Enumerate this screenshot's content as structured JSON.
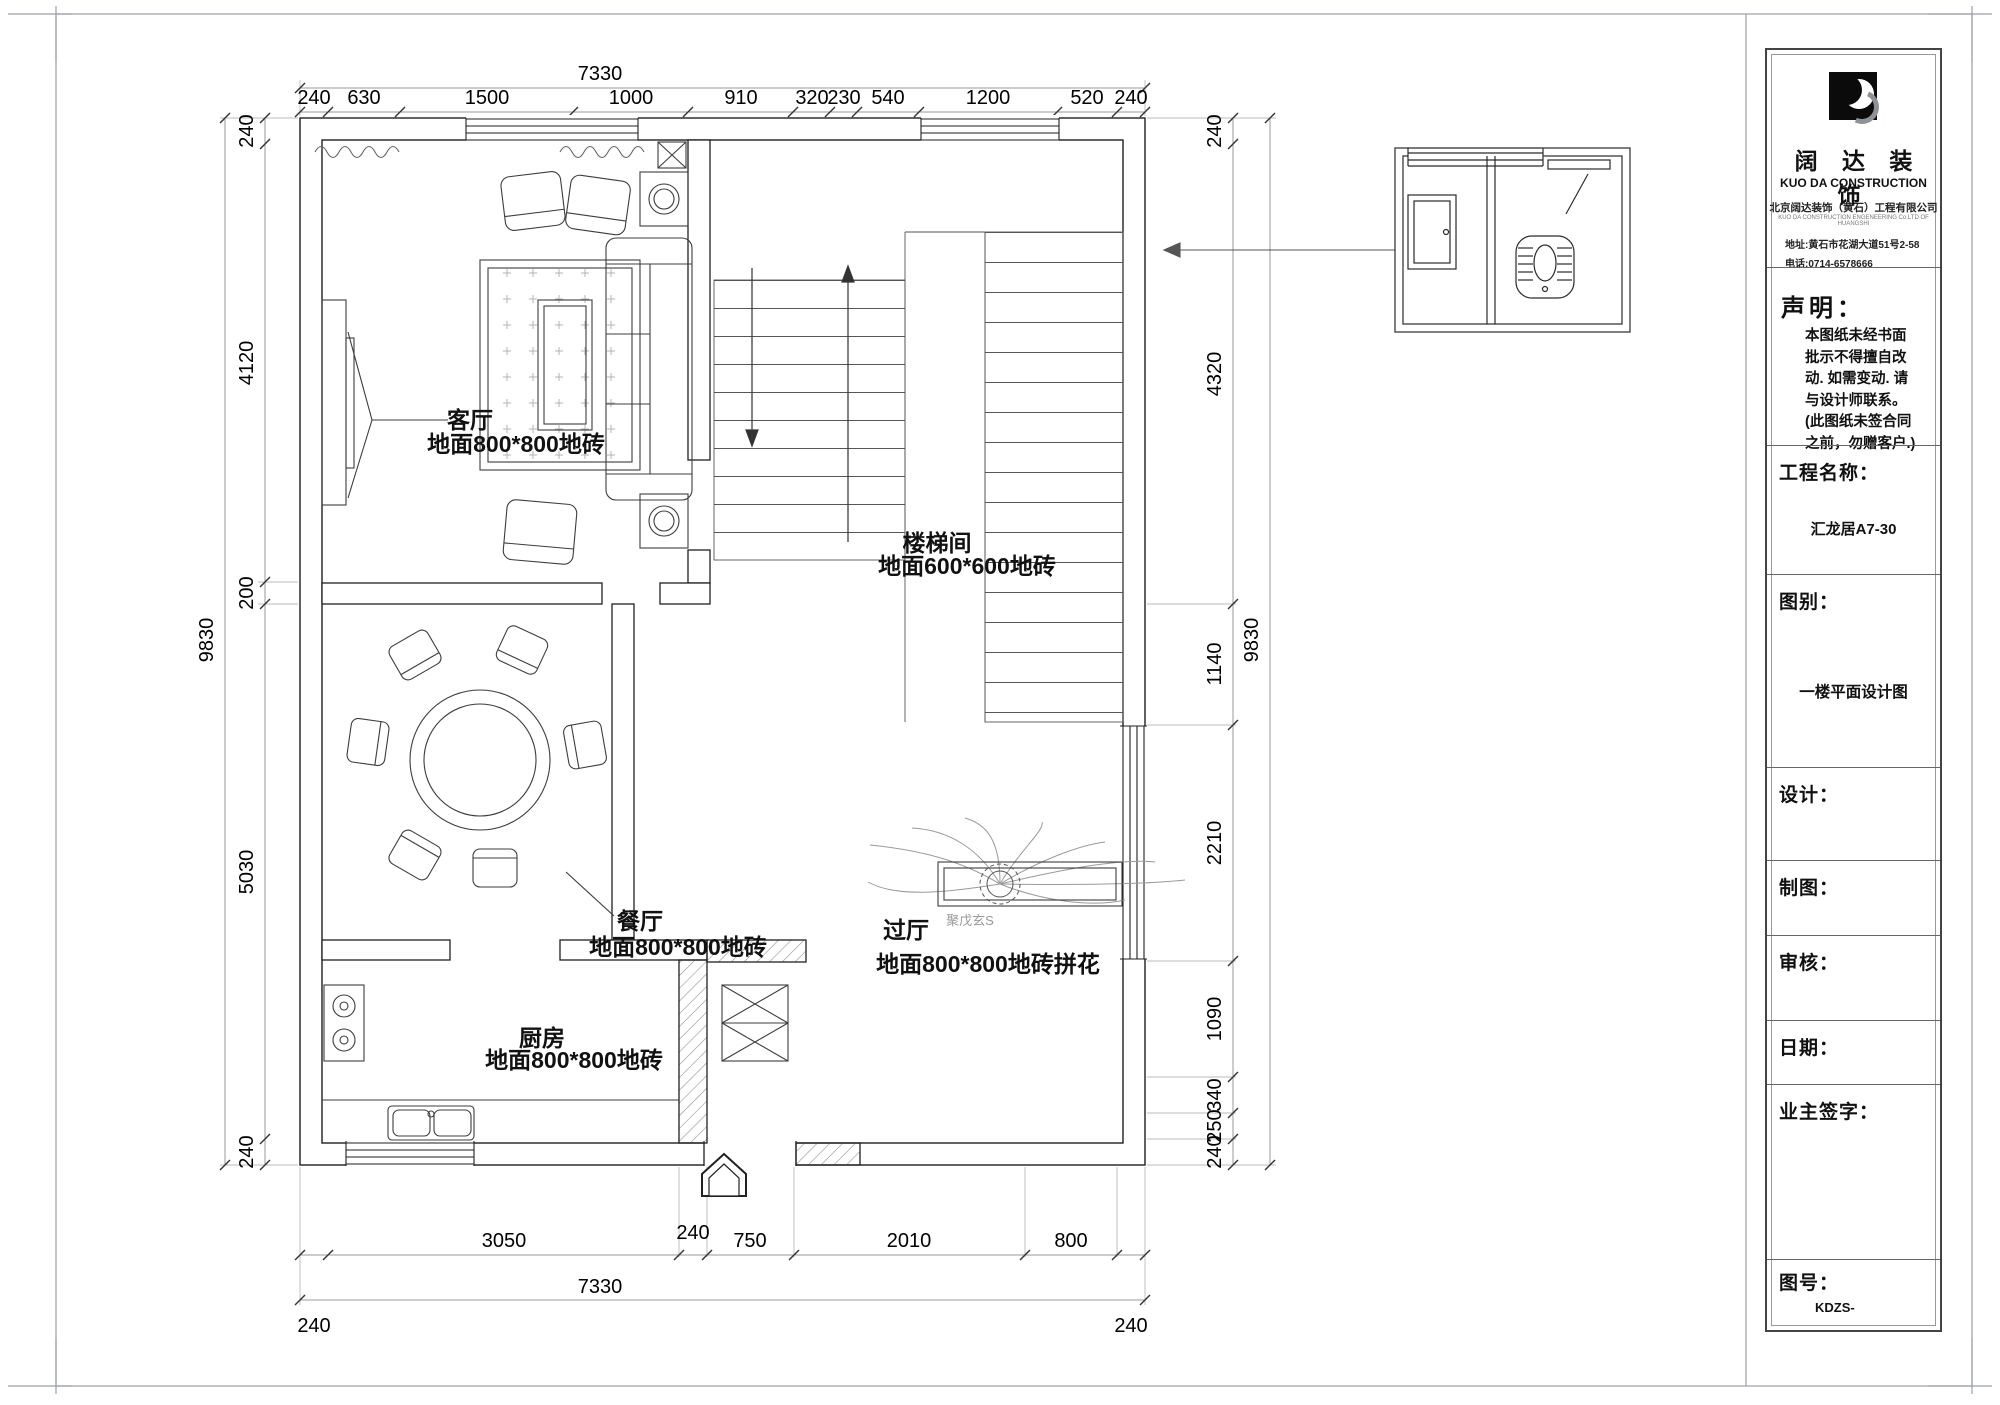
{
  "plan": {
    "rooms": {
      "living": {
        "name": "客厅",
        "floor": "地面800*800地砖"
      },
      "stair": {
        "name": "楼梯间",
        "floor": "地面600*600地砖"
      },
      "dining": {
        "name": "餐厅",
        "floor": "地面800*800地砖"
      },
      "kitchen": {
        "name": "厨房",
        "floor": "地面800*800地砖"
      },
      "hall": {
        "name": "过厅",
        "floor": "地面800*800地砖拼花"
      }
    },
    "watermark": "聚戊玄S"
  },
  "dims": {
    "top": {
      "overall": "7330",
      "segs": [
        "240",
        "630",
        "1500",
        "1000",
        "910",
        "320",
        "230",
        "540",
        "1200",
        "520",
        "240"
      ]
    },
    "bottom": {
      "overall": "7330",
      "upper": [
        "3050",
        "240",
        "750",
        "2010",
        "800"
      ],
      "corner_left": "240",
      "corner_right": "240"
    },
    "left": {
      "overall": "9830",
      "segs": [
        "240",
        "4120",
        "200",
        "5030",
        "240"
      ]
    },
    "right": {
      "overall": "9830",
      "segs": [
        "240",
        "4320",
        "1140",
        "2210",
        "1090",
        "340",
        "250",
        "240"
      ]
    }
  },
  "titleblock": {
    "brand": {
      "cn": "阔 达 装 饰",
      "en": "KUO DA CONSTRUCTION",
      "company": "北京阔达装饰（黄石）工程有限公司",
      "company_en": "KUO DA CONSTRUCTION ENGENEERING Co.LTD OF HUANGSHI",
      "address": "地址:黄石市花湖大道51号2-58",
      "phone": "电话:0714-6578666"
    },
    "statement": {
      "title": "声明：",
      "lines": [
        "本图纸未经书面",
        "批示不得擅自改",
        "动. 如需变动. 请",
        "与设计师联系。",
        "(此图纸未签合同",
        "之前，勿赠客户.)"
      ]
    },
    "fields": {
      "project_label": "工程名称：",
      "project_value": "汇龙居A7-30",
      "type_label": "图别：",
      "type_value": "一楼平面设计图",
      "design_label": "设计：",
      "draft_label": "制图：",
      "review_label": "审核：",
      "date_label": "日期：",
      "owner_label": "业主签字：",
      "number_label": "图号：",
      "number_value": "KDZS-"
    }
  }
}
